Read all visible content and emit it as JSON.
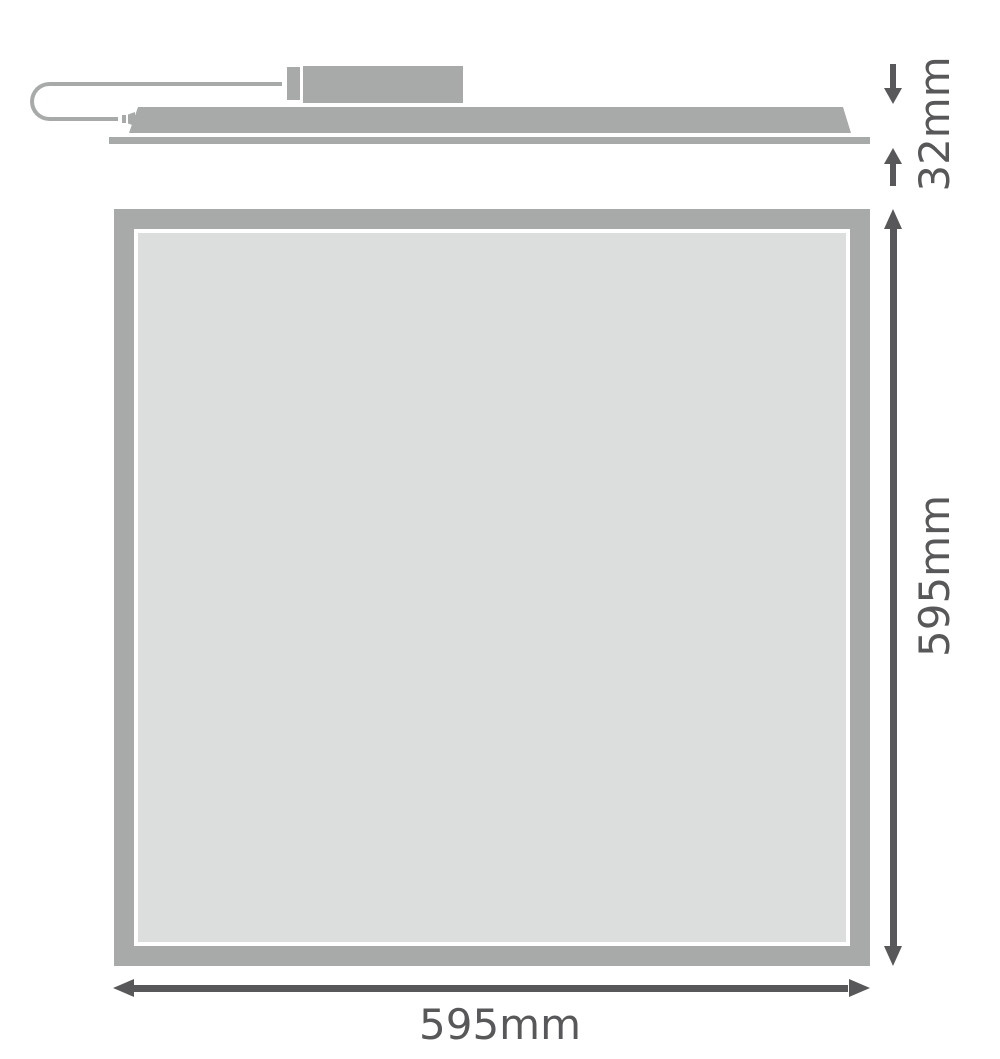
{
  "colors": {
    "background": "#ffffff",
    "shape": "#a8a9a9",
    "panel-face": "#dcdddd",
    "dimension": "#58585a"
  },
  "side_view": {
    "height_label": "32mm"
  },
  "front_view": {
    "height_label": "595mm",
    "width_label": "595mm"
  }
}
